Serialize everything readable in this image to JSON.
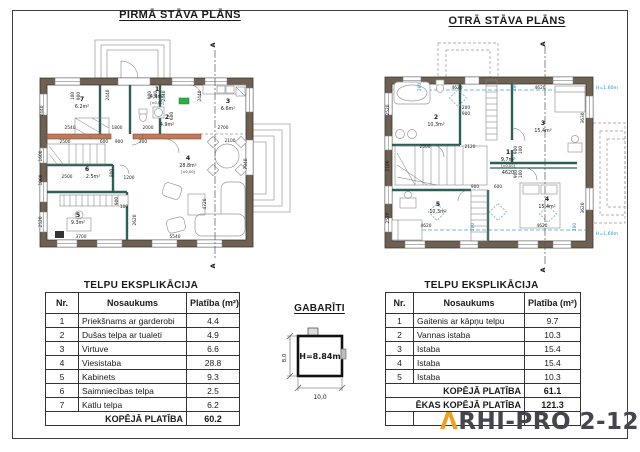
{
  "page": {
    "colors": {
      "wall": "#6e6052",
      "interior_wall_teal": "#2c5f58",
      "lintel_red": "#bd7a5c",
      "height_line_blue": "#2f8fd0",
      "logo_mark_orange": "#f09e1e",
      "logo_text_gray": "#45454e"
    }
  },
  "p1": {
    "title": "PIRMĀ STĀVA PLĀNS",
    "section": "A",
    "rooms": [
      {
        "num": "7",
        "area": "6.2m²"
      },
      {
        "num": "1",
        "area": "4.4m²",
        "level": "[±0,00]"
      },
      {
        "num": "2",
        "area": "4.9m²"
      },
      {
        "num": "3",
        "area": "6.6m²"
      },
      {
        "num": "4",
        "area": "28.8m²",
        "level": "[±0,00]"
      },
      {
        "num": "6",
        "area": "2.5m²"
      },
      {
        "num": "5",
        "area": "9.3m²"
      }
    ],
    "dims": [
      {
        "x": 45,
        "y": 97,
        "v": "2540"
      },
      {
        "x": 92,
        "y": 97,
        "v": "1800"
      },
      {
        "x": 123,
        "y": 97,
        "v": "2000"
      },
      {
        "x": 198,
        "y": 97,
        "v": "2700"
      },
      {
        "x": 148,
        "y": 84,
        "v": "600",
        "r": -90
      },
      {
        "x": 18,
        "y": 79,
        "v": "2440",
        "r": -90
      },
      {
        "x": 49,
        "y": 64,
        "v": "100",
        "r": -90
      },
      {
        "x": 55,
        "y": 64,
        "v": "900",
        "r": -90
      },
      {
        "x": 84,
        "y": 63,
        "v": "2440",
        "r": -90
      },
      {
        "x": 126,
        "y": 63,
        "v": "900",
        "r": -90
      },
      {
        "x": 132,
        "y": 63,
        "v": "100",
        "r": -90
      },
      {
        "x": 140,
        "y": 64,
        "v": "2440",
        "r": -90
      },
      {
        "x": 176,
        "y": 64,
        "v": "2440",
        "r": -90
      },
      {
        "x": 40,
        "y": 111,
        "v": "2500"
      },
      {
        "x": 79,
        "y": 111,
        "v": "600"
      },
      {
        "x": 94,
        "y": 111,
        "v": "900"
      },
      {
        "x": 118,
        "y": 111,
        "v": "300"
      },
      {
        "x": 205,
        "y": 110,
        "v": "2100"
      },
      {
        "x": 17,
        "y": 124,
        "v": "1600",
        "r": -90
      },
      {
        "x": 17,
        "y": 148,
        "v": "1000",
        "r": -90
      },
      {
        "x": 17,
        "y": 190,
        "v": "2520",
        "r": -90
      },
      {
        "x": 42,
        "y": 146,
        "v": "2500"
      },
      {
        "x": 88,
        "y": 141,
        "v": "800",
        "r": -90
      },
      {
        "x": 104,
        "y": 147,
        "v": "1200"
      },
      {
        "x": 93,
        "y": 169,
        "v": "900",
        "r": -90
      },
      {
        "x": 99,
        "y": 176,
        "v": "100"
      },
      {
        "x": 56,
        "y": 206,
        "v": "3700"
      },
      {
        "x": 150,
        "y": 206,
        "v": "5540"
      },
      {
        "x": 111,
        "y": 188,
        "v": "2620",
        "r": -90
      },
      {
        "x": 181,
        "y": 172,
        "v": "4720",
        "r": -90
      },
      {
        "x": 222,
        "y": 132,
        "v": "7940",
        "r": -90
      }
    ]
  },
  "p2": {
    "title": "OTRĀ STĀVA PLĀNS",
    "section": "A",
    "hline": "H=1,60m",
    "rooms": [
      {
        "num": "2",
        "area": "10,3m²"
      },
      {
        "num": "3",
        "area": "15,4m²"
      },
      {
        "num": "1",
        "area": "9,7m²",
        "level": "[±0,00]",
        "below": "4620"
      },
      {
        "num": "5",
        "area": "10,3m²"
      },
      {
        "num": "4",
        "area": "15,4m²"
      }
    ],
    "dims": [
      {
        "x": 87,
        "y": 51,
        "v": "4620"
      },
      {
        "x": 170,
        "y": 51,
        "v": "4620"
      },
      {
        "x": 19,
        "y": 72,
        "v": "2520",
        "r": -90
      },
      {
        "x": 55,
        "y": 110,
        "v": "2500"
      },
      {
        "x": 100,
        "y": 110,
        "v": "2120"
      },
      {
        "x": 96,
        "y": 71,
        "v": "200"
      },
      {
        "x": 96,
        "y": 77,
        "v": "900"
      },
      {
        "x": 19,
        "y": 128,
        "v": "2100",
        "r": -90
      },
      {
        "x": 105,
        "y": 150,
        "v": "900"
      },
      {
        "x": 128,
        "y": 150,
        "v": "600"
      },
      {
        "x": 56,
        "y": 189,
        "v": "4620"
      },
      {
        "x": 172,
        "y": 189,
        "v": "4620"
      },
      {
        "x": 214,
        "y": 80,
        "v": "3630",
        "r": -90
      },
      {
        "x": 214,
        "y": 170,
        "v": "3620",
        "r": -90
      },
      {
        "x": 19,
        "y": 180,
        "v": "2520",
        "r": -90
      },
      {
        "x": 147,
        "y": 112,
        "v": "900",
        "r": -90
      },
      {
        "x": 152,
        "y": 112,
        "v": "100",
        "r": -90
      },
      {
        "x": 147,
        "y": 136,
        "v": "900",
        "r": -90
      },
      {
        "x": 152,
        "y": 136,
        "v": "100",
        "r": -90
      },
      {
        "x": 51,
        "y": 49,
        "v": "280",
        "r": -90,
        "c": "b"
      },
      {
        "x": 146,
        "y": 49,
        "v": "280",
        "r": -90,
        "c": "b"
      },
      {
        "x": 104,
        "y": 189,
        "v": "280",
        "r": -90,
        "c": "b"
      },
      {
        "x": 206,
        "y": 189,
        "v": "280",
        "r": -90,
        "c": "b"
      }
    ]
  },
  "t1": {
    "title": "TELPU EKSPLIKĀCIJA",
    "headers": [
      "Nr.",
      "Nosaukums",
      "Platība (m²)"
    ],
    "rows": [
      [
        "1",
        "Priekšnams ar garderobi",
        "4.4"
      ],
      [
        "2",
        "Dušas telpa ar tualeti",
        "4.9"
      ],
      [
        "3",
        "Virtuve",
        "6.6"
      ],
      [
        "4",
        "Viesistaba",
        "28.8"
      ],
      [
        "5",
        "Kabinets",
        "9.3"
      ],
      [
        "6",
        "Saimniecības telpa",
        "2.5"
      ],
      [
        "7",
        "Katlu telpa",
        "6.2"
      ]
    ],
    "total_label": "KOPĒJĀ PLATĪBA",
    "total_value": "60.2"
  },
  "t2": {
    "title": "TELPU EKSPLIKĀCIJA",
    "headers": [
      "Nr.",
      "Nosaukums",
      "Platība (m²)"
    ],
    "rows": [
      [
        "1",
        "Gaitenis ar kāpņu telpu",
        "9.7"
      ],
      [
        "2",
        "Vannas istaba",
        "10.3"
      ],
      [
        "3",
        "Istaba",
        "15.4"
      ],
      [
        "4",
        "Istaba",
        "15.4"
      ],
      [
        "5",
        "Istaba",
        "10.3"
      ]
    ],
    "total_label": "KOPĒJĀ PLATĪBA",
    "total_value": "61.1",
    "total2_label": "ĒKAS KOPĒJĀ PLATĪBA",
    "total2_value": "121.3"
  },
  "gab": {
    "title": "GABARĪTI",
    "height": "H=8.84m",
    "width": "10,0",
    "depth": "8,0"
  },
  "logo": {
    "mark": "Λ",
    "text": "RHI-PRO 2-121"
  }
}
